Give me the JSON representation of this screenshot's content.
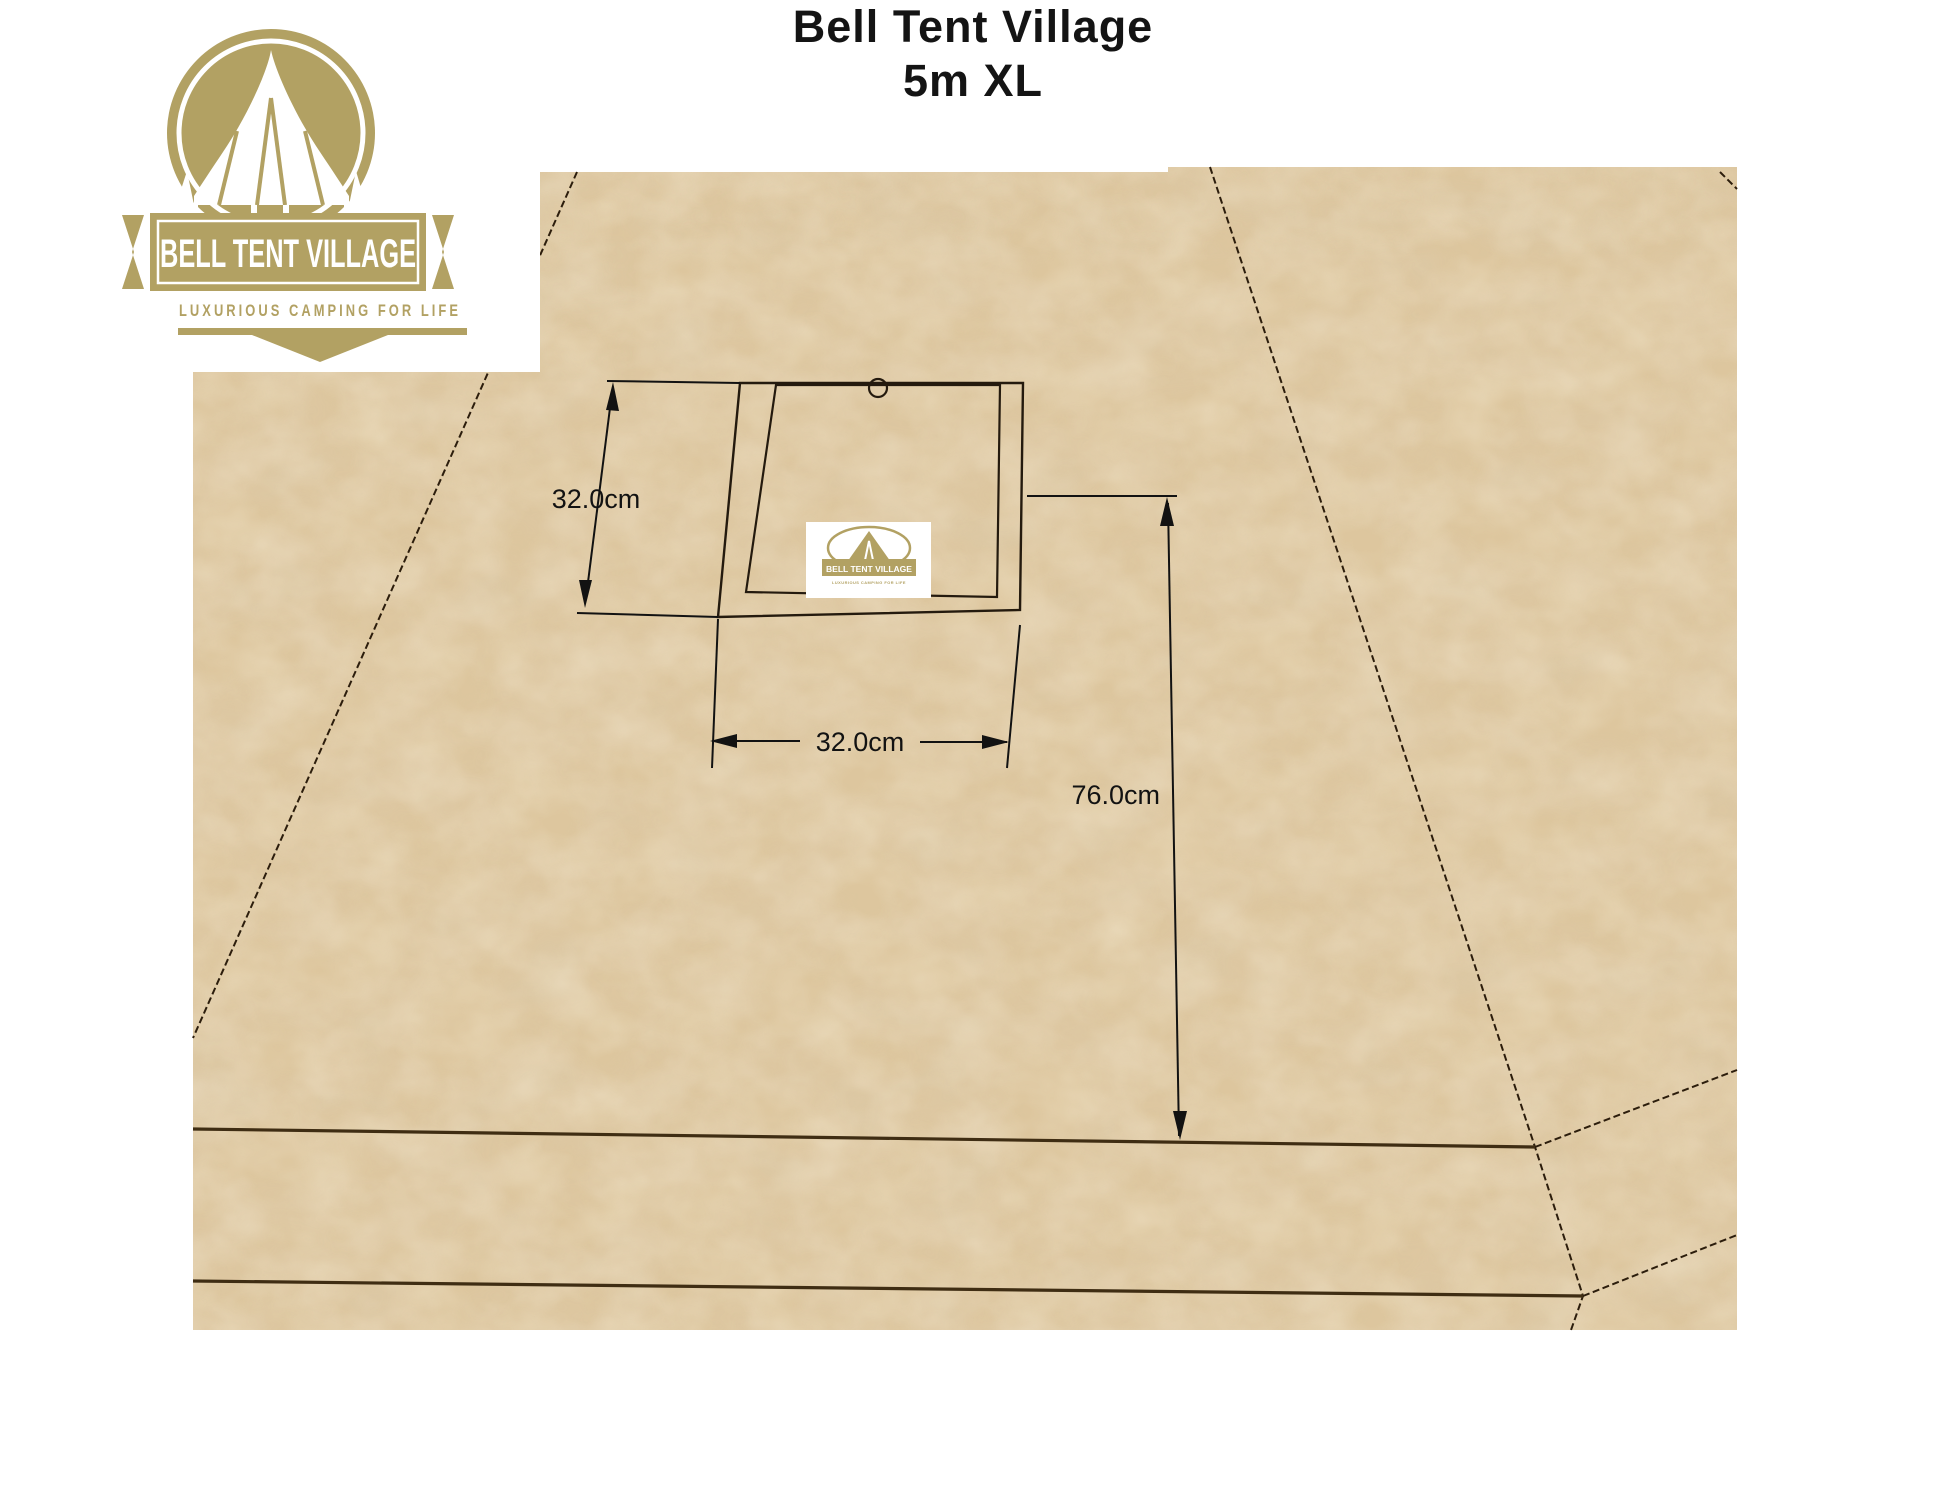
{
  "title": {
    "line1": "Bell Tent Village",
    "line2": "5m XL"
  },
  "logo": {
    "brand": "BELL TENT VILLAGE",
    "tagline": "LUXURIOUS CAMPING FOR LIFE"
  },
  "diagram": {
    "dim_square_height": "32.0cm",
    "dim_square_width": "32.0cm",
    "dim_offset_right": "76.0cm"
  },
  "colors": {
    "brand_gold": "#b2a163",
    "canvas_base": "#ddc69e",
    "canvas_shadow": "#b89a6a",
    "outline_dark": "#241a0e",
    "crease_brown": "#3f2d13",
    "dimension_ink": "#121212"
  }
}
